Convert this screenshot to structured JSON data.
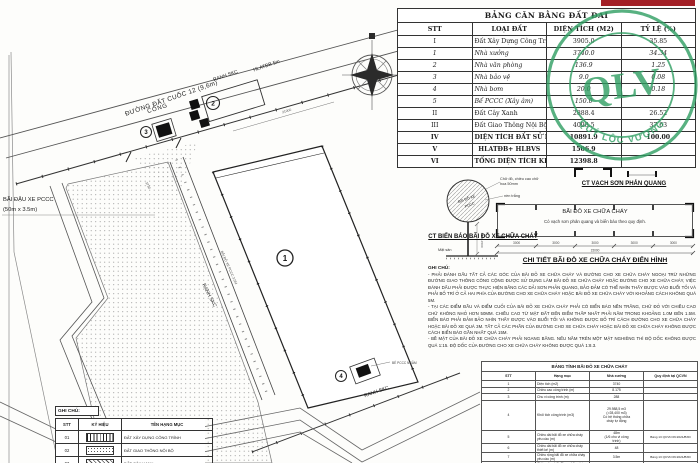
{
  "page": {
    "bg": "#ffffff"
  },
  "stamp": {
    "text": "QLV",
    "arc": "QUÝ LỘC VƯỢNG",
    "color": "#2f9e62"
  },
  "land_table": {
    "title": "BẢNG CÂN BẰNG ĐẤT ĐAI",
    "headers": [
      "STT",
      "LOẠI ĐẤT",
      "DIỆN TÍCH (M2)",
      "TỶ LỆ (%)"
    ],
    "rows": [
      {
        "no": "I",
        "name": "Đất Xây Dựng Công Trình",
        "area": "3905.0",
        "ratio": "35.85"
      },
      {
        "no": "1",
        "name": "Nhà xưởng",
        "area": "3740.0",
        "ratio": "34.34"
      },
      {
        "no": "2",
        "name": "Nhà văn phòng",
        "area": "136.9",
        "ratio": "1.25"
      },
      {
        "no": "3",
        "name": "Nhà bảo vệ",
        "area": "9.0",
        "ratio": "0.08"
      },
      {
        "no": "4",
        "name": "Nhà bơm",
        "area": "20.0",
        "ratio": "0.18"
      },
      {
        "no": "5",
        "name": "Bể PCCC (Xây âm)",
        "area": "150.0",
        "ratio": ""
      },
      {
        "no": "II",
        "name": "Đất Cây Xanh",
        "area": "2888.4",
        "ratio": "26.52"
      },
      {
        "no": "III",
        "name": "Đất Giao Thông Nội Bộ+ Đất Trống",
        "area": "4098.5",
        "ratio": "37.63"
      },
      {
        "no": "IV",
        "name": "DIỆN TÍCH ĐẤT SỬ DỤNG",
        "area": "10891.9",
        "ratio": "100.00"
      },
      {
        "no": "V",
        "name": "HLATĐB+ HLBVS",
        "area": "1506.9",
        "ratio": ""
      },
      {
        "no": "VI",
        "name": "TỔNG DIỆN TÍCH KHU ĐẤT",
        "area": "12398.8",
        "ratio": ""
      }
    ]
  },
  "plan": {
    "road_label": "ĐƯỜNG ĐẤT CUỐC 12 (9,6m)",
    "ranh_skc_top": "RANH SKC",
    "hlatdb": "HLATĐB 5m",
    "cong": "CỔNG",
    "bai_dau_1": "BÃI ĐẬU XE PCCC",
    "bai_dau_2": "(50m x 3.5m)",
    "ranh_skc_mid": "RANH SKC",
    "ranh_skc_bot": "RANH SKC",
    "lane_label": "BÃI ĐỖ XE PCCC 3.5M",
    "pump_label": "BỂ PCCC NGẦM",
    "dim_a": "3730",
    "dim_b": "21000",
    "num_1": "1",
    "num_2": "2",
    "num_3": "3",
    "num_4": "4"
  },
  "sign_detail": {
    "circle_line1": "BÃI ĐỖ XE",
    "circle_line2": "PCCC",
    "label_color": "Chữ đỏ, chiều cao chữ\nhoa 50mm",
    "label_bg": "nền trắng",
    "label_ground": "Mặt sân",
    "dim": "1000÷1500",
    "caption": "CT BIỂN BÁO BÃI ĐỖ XE CHỮA CHÁY"
  },
  "paint_detail": {
    "caption": "CT VẠCH SƠN PHẢN QUANG"
  },
  "parking_detail": {
    "line1": "BÃI ĐỖ XE CHỮA CHÁY",
    "line2": "Có vạch sơn phản quang và biển báo theo quy định.",
    "seg": "3000",
    "total": "15000",
    "caption": "CHI TIẾT BÃI ĐỖ XE CHỮA CHÁY ĐIỂN HÌNH"
  },
  "notes": {
    "heading": "GHI CHÚ:",
    "items": [
      "- PHẢI ĐÁNH DẤU TẤT CẢ CÁC GÓC CỦA BÃI ĐỖ XE CHỮA CHÁY VÀ ĐƯỜNG CHO XE CHỮA CHÁY NGOẠI TRỪ NHỮNG ĐƯỜNG GIAO THÔNG CÔNG CỘNG ĐƯỢC SỬ DỤNG LÀM BÃI ĐỖ XE CHỮA CHÁY HOẶC ĐƯỜNG CHO XE CHỮA CHÁY, VIỆC ĐÁNH DẤU PHẢI ĐƯỢC THỰC HIỆN BẰNG CÁC DẢI SƠN PHẢN QUANG, BẢO ĐẢM CÓ THỂ NHÌN THẤY ĐƯỢC VÀO BUỔI TỐI VÀ PHẢI BỐ TRÍ Ở CẢ HAI PHÍA CỦA ĐƯỜNG CHO XE CHỮA CHÁY HOẶC BÃI ĐỖ XE CHỮA CHÁY VỚI KHOẢNG CÁCH KHÔNG QUÁ 5M.",
      "- TẠI CÁC ĐIỂM ĐẦU VÀ ĐIỂM CUỐI CỦA BÃI ĐỖ XE CHỮA CHÁY PHẢI CÓ BIỂN BÁO NỀN TRẮNG, CHỮ ĐỎ VỚI CHIỀU CAO CHỮ KHÔNG NHỎ HƠN 50MM. CHIỀU CAO TỪ MẶT ĐẤT ĐẾN ĐIỂM THẤP NHẤT PHẢI NẰM TRONG KHOẢNG 1.0M ĐẾN 1.5M. BIỂN BÁO PHẢI ĐẢM BẢO NHÌN THẤY ĐƯỢC VÀO BUỔI TỐI VÀ KHÔNG ĐƯỢC BỐ TRÍ CÁCH ĐƯỜNG CHO XE CHỮA CHÁY HOẶC BÃI ĐỖ XE QUÁ 3M. TẤT CẢ CÁC PHẦN CỦA ĐƯỜNG CHO XE CHỮA CHÁY HOẶC BÃI ĐỖ XE CHỮA CHÁY KHÔNG ĐƯỢC CÁCH BIỂN BÁO GẦN NHẤT QUÁ 15M.",
      "- BỀ MẶT CỦA BÃI ĐỖ XE CHỮA CHÁY PHẢI NGANG BẰNG. NẾU NẰM TRÊN MỘT MẶT NGHIÊNG THÌ ĐỘ DỐC KHÔNG ĐƯỢC QUÁ 1:15. ĐỘ DỐC CỦA ĐƯỜNG CHO XE CHỮA CHÁY KHÔNG ĐƯỢC QUÁ 1:8.3."
    ]
  },
  "calc_table": {
    "title": "BẢNG TÍNH BÃI ĐỖ XE CHỮA CHÁY",
    "headers": [
      "STT",
      "Hạng mục",
      "Nhà xưởng",
      "Quy định tại QCVN"
    ],
    "rows": [
      {
        "no": "1",
        "item": "Diện tích (m2)",
        "value": "3740",
        "ref": ""
      },
      {
        "no": "2",
        "item": "Chiều cao công trình (m)",
        "value": "8.175",
        "ref": ""
      },
      {
        "no": "3",
        "item": "Chu vi công trình (m)",
        "value": "288",
        "ref": ""
      },
      {
        "no": "4",
        "item": "Khối tích công trình (m3)",
        "value": "29.988,5 m3\n(>28,400 m3)\nCó hệ thống chữa\ncháy tự động",
        "ref": ""
      },
      {
        "no": "5",
        "item": "Chiều dài bãi đỗ xe chữa cháy yêu cầu (m)",
        "value": "48m\n(1/6 chu vi công\ntrình)",
        "ref": "Bảng 13 QCVN 06:2021/BXD"
      },
      {
        "no": "6",
        "item": "Chiều dài bãi đỗ xe chữa cháy thiết kế (m)",
        "value": "48",
        "ref": ""
      },
      {
        "no": "7",
        "item": "Chiều rộng bãi đỗ xe chữa cháy yêu cầu (m)",
        "value": "3.5m",
        "ref": "Bảng 13 QCVN 06:2021/BXD"
      },
      {
        "no": "8",
        "item": "Chiều rộng bãi đỗ xe chữa cháy thiết kế (m)",
        "value": "3.5m",
        "ref": ""
      }
    ]
  },
  "legend": {
    "heading": "GHI CHÚ:",
    "headers": [
      "STT",
      "KÝ HIỆU",
      "TÊN HẠNG MỤC"
    ],
    "rows": [
      {
        "no": "01",
        "name": "ĐẤT XÂY DỰNG CÔNG TRÌNH"
      },
      {
        "no": "02",
        "name": "ĐẤT GIAO THÔNG NỘI BỘ"
      },
      {
        "no": "03",
        "name": "ĐẤT CÂY XANH"
      }
    ]
  }
}
